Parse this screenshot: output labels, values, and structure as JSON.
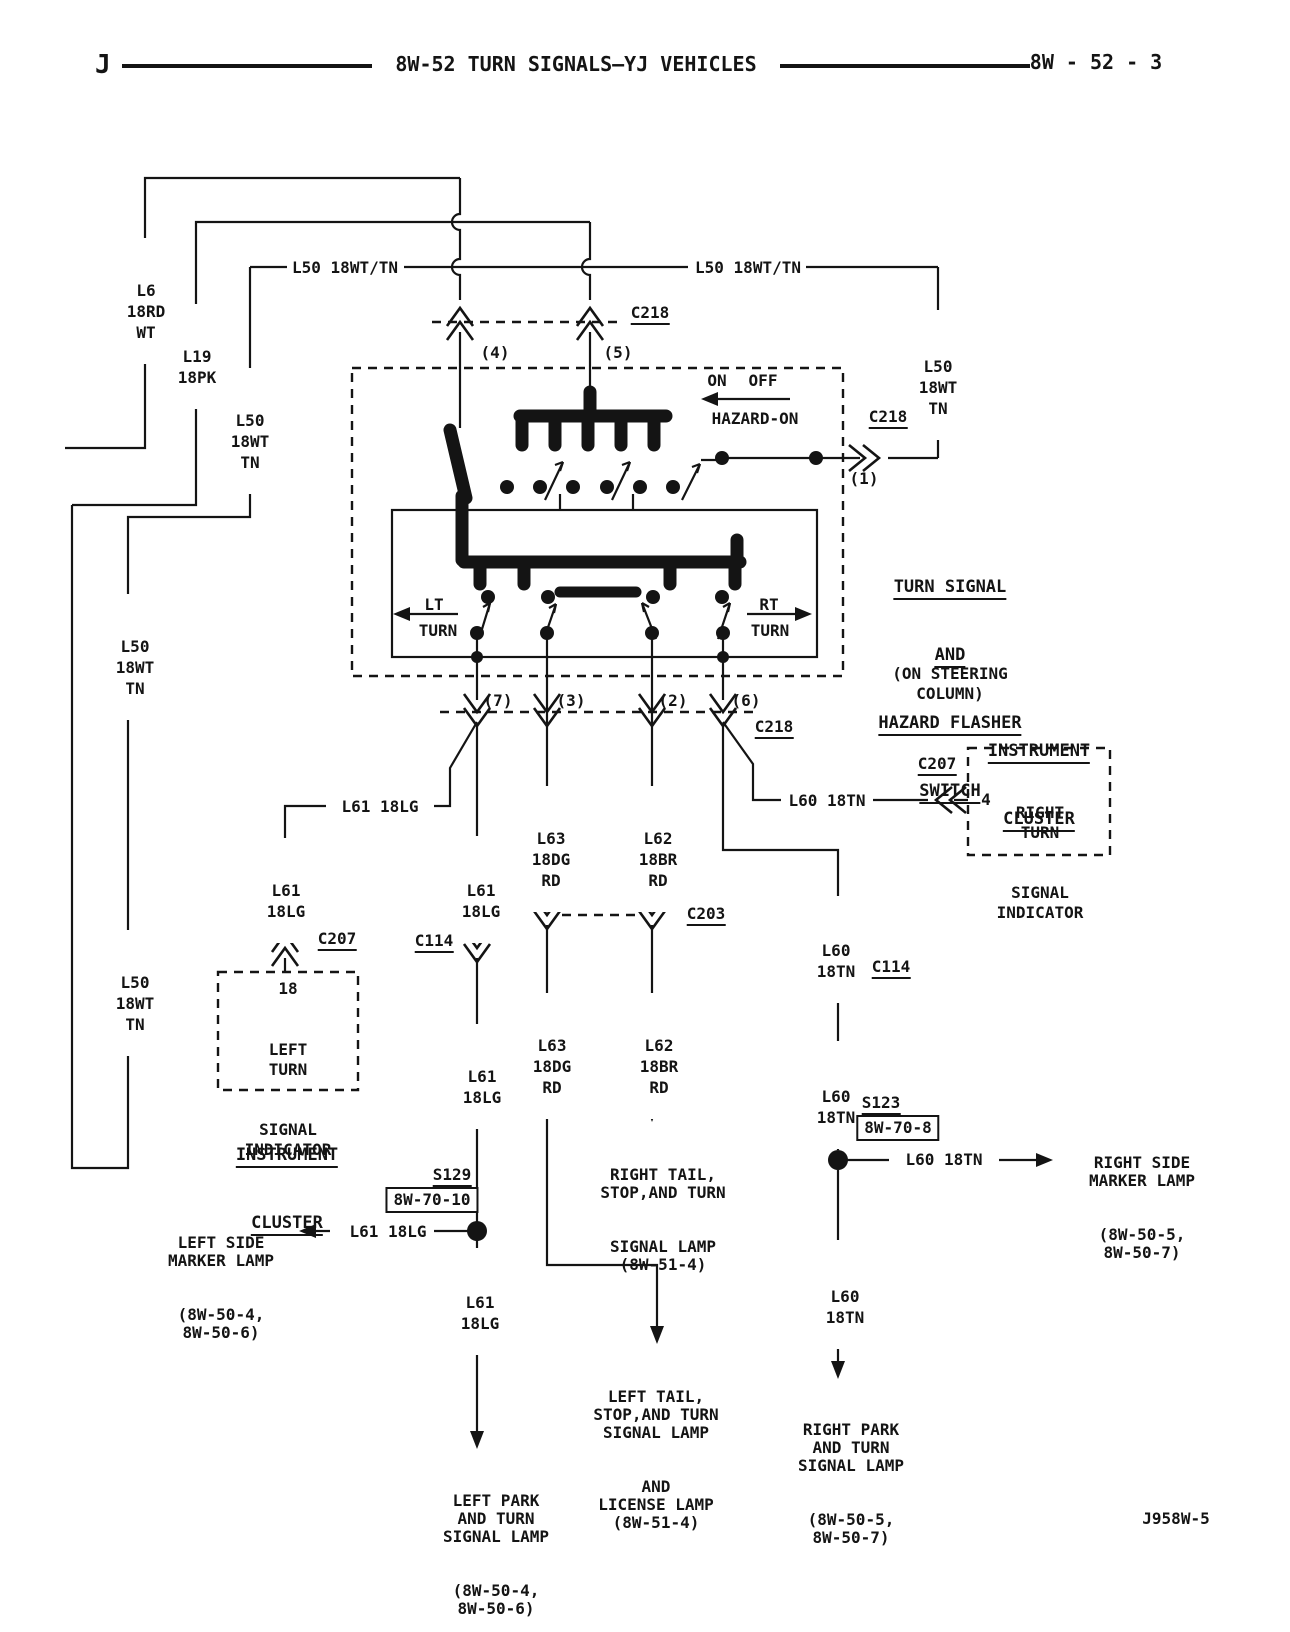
{
  "header": {
    "page_letter": "J",
    "title": "8W-52 TURN SIGNALS—YJ VEHICLES",
    "page_ref": "8W - 52 - 3"
  },
  "figure_id": "J958W-5",
  "colors": {
    "ink": "#141414",
    "paper": "#ffffff"
  },
  "wire_labels": {
    "l6": [
      "L6",
      "18RD",
      "WT"
    ],
    "l19": [
      "L19",
      "18PK"
    ],
    "l50_left": [
      "L50",
      "18WT",
      "TN"
    ],
    "l50_feed_left": "L50 18WT/TN",
    "l50_feed_right": "L50 18WT/TN",
    "l50_right": [
      "L50",
      "18WT",
      "TN"
    ],
    "l50_mid_upper": [
      "L50",
      "18WT",
      "TN"
    ],
    "l50_mid_lower": [
      "L50",
      "18WT",
      "TN"
    ],
    "l61_branch": "L61 18LG",
    "l61_to_cluster": [
      "L61",
      "18LG"
    ],
    "l61_above_c114": [
      "L61",
      "18LG"
    ],
    "l61_below_c114": [
      "L61",
      "18LG"
    ],
    "l61_spur": "L61 18LG",
    "l61_bottom": [
      "L61",
      "18LG"
    ],
    "l63_upper": [
      "L63",
      "18DG",
      "RD"
    ],
    "l63_lower": [
      "L63",
      "18DG",
      "RD"
    ],
    "l62_upper": [
      "L62",
      "18BR",
      "RD"
    ],
    "l62_lower": [
      "L62",
      "18BR",
      "RD"
    ],
    "l60_branch": "L60 18TN",
    "l60_above_c114": [
      "L60",
      "18TN"
    ],
    "l60_below_c114": [
      "L60",
      "18TN"
    ],
    "l60_spur": "L60 18TN",
    "l60_bottom": [
      "L60",
      "18TN"
    ]
  },
  "connectors": {
    "c218_top": "C218",
    "c218_right": "C218",
    "c218_bottom": "C218",
    "c207_left": "C207",
    "c207_right": "C207",
    "c203": "C203",
    "c114_left": "C114",
    "c114_right": "C114"
  },
  "pins": {
    "p1": "(1)",
    "p2": "(2)",
    "p3": "(3)",
    "p4": "(4)",
    "p5": "(5)",
    "p6": "(6)",
    "p7": "(7)",
    "c207_left_pin": "18",
    "c207_right_pin": "4"
  },
  "splices": {
    "s123": {
      "name": "S123",
      "ref": "8W-70-8"
    },
    "s129": {
      "name": "S129",
      "ref": "8W-70-10"
    }
  },
  "switch": {
    "title": [
      "TURN SIGNAL",
      "AND",
      "HAZARD FLASHER",
      "SWITCH"
    ],
    "subtitle": [
      "(ON STEERING",
      "COLUMN)"
    ],
    "on": "ON",
    "off": "OFF",
    "hazard": "HAZARD-ON",
    "lt": "LT",
    "lt_turn": "TURN",
    "rt": "RT",
    "rt_turn": "TURN"
  },
  "clusters": {
    "left": {
      "title": [
        "INSTRUMENT",
        "CLUSTER"
      ],
      "indicator": [
        "LEFT",
        "TURN",
        "SIGNAL",
        "INDICATOR"
      ]
    },
    "right": {
      "title": [
        "INSTRUMENT",
        "CLUSTER"
      ],
      "indicator": [
        "RIGHT",
        "TURN",
        "SIGNAL",
        "INDICATOR"
      ]
    }
  },
  "lamps": {
    "left_side_marker": [
      "LEFT SIDE",
      "MARKER LAMP",
      "(8W-50-4,",
      "8W-50-6)"
    ],
    "right_side_marker": [
      "RIGHT SIDE",
      "MARKER LAMP",
      "(8W-50-5,",
      "8W-50-7)"
    ],
    "left_park": [
      "LEFT PARK",
      "AND TURN",
      "SIGNAL LAMP",
      "(8W-50-4,",
      "8W-50-6)"
    ],
    "right_park": [
      "RIGHT PARK",
      "AND TURN",
      "SIGNAL LAMP",
      "(8W-50-5,",
      "8W-50-7)"
    ],
    "right_tail": [
      "RIGHT TAIL,",
      "STOP,AND TURN",
      "SIGNAL LAMP",
      "(8W-51-4)"
    ],
    "left_tail": [
      "LEFT TAIL,",
      "STOP,AND TURN",
      "SIGNAL LAMP",
      "AND",
      "LICENSE LAMP",
      "(8W-51-4)"
    ]
  }
}
